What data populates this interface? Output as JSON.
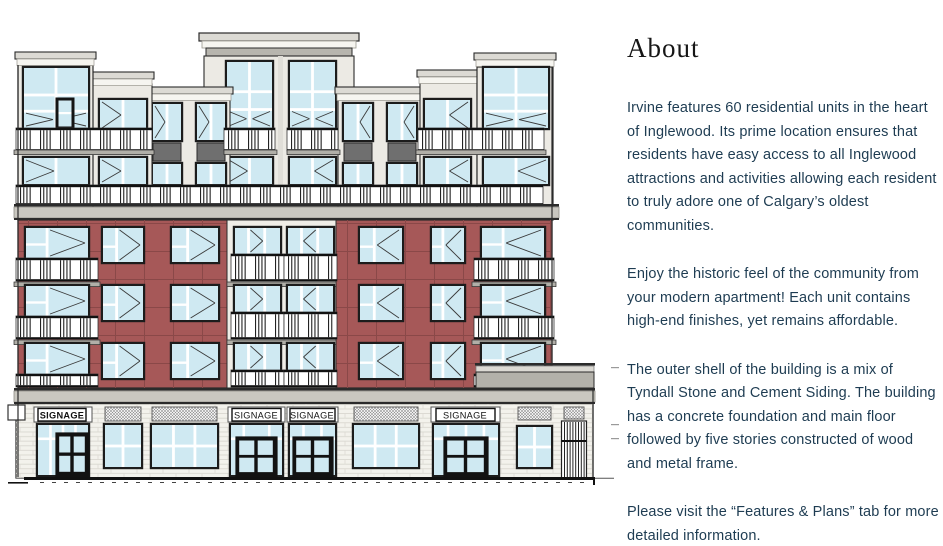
{
  "about": {
    "heading": "About",
    "paragraphs": [
      "Irvine features 60 residential units in the heart of Inglewood. Its prime location ensures that residents have easy access to all Inglewood attractions and activities allowing each resident to truly adore one of Calgary’s oldest communities.",
      "Enjoy the historic feel of the community from your modern apartment! Each unit contains high-end finishes, yet remains affordable.",
      "The outer shell of the building is a mix of Tyndall Stone and Cement Siding. The building has a concrete foundation and main floor followed by five stories constructed of wood and metal frame.",
      "Please visit the “Features & Plans” tab for more detailed information."
    ]
  },
  "building": {
    "description": "Front elevation architectural drawing of a six-storey mixed-use building",
    "signage_panels": [
      {
        "label": "SIGNAGE"
      },
      {
        "label": "SIGNAGE"
      },
      {
        "label": "SIGNAGE"
      },
      {
        "label": "SIGNAGE"
      }
    ],
    "palette": {
      "brick": "#a65858",
      "brick_joint": "#8a4848",
      "glass": "#cfe9f2",
      "frame": "#1c1c1c",
      "siding": "#eceae4",
      "trim": "#f6f5f0",
      "cap": "#b7b5ae",
      "cap_light": "#dcdad4",
      "spandrel": "#6f6f6f",
      "ground_brick": "#f3f2ec",
      "course_line": "#d8d6cf",
      "cornice": "#c9c7c0",
      "outline": "#2b2b2b",
      "slab": "#b1afa8",
      "text_body": "#1e3c52",
      "text_heading": "#161616",
      "signage_text": "#111111"
    }
  }
}
